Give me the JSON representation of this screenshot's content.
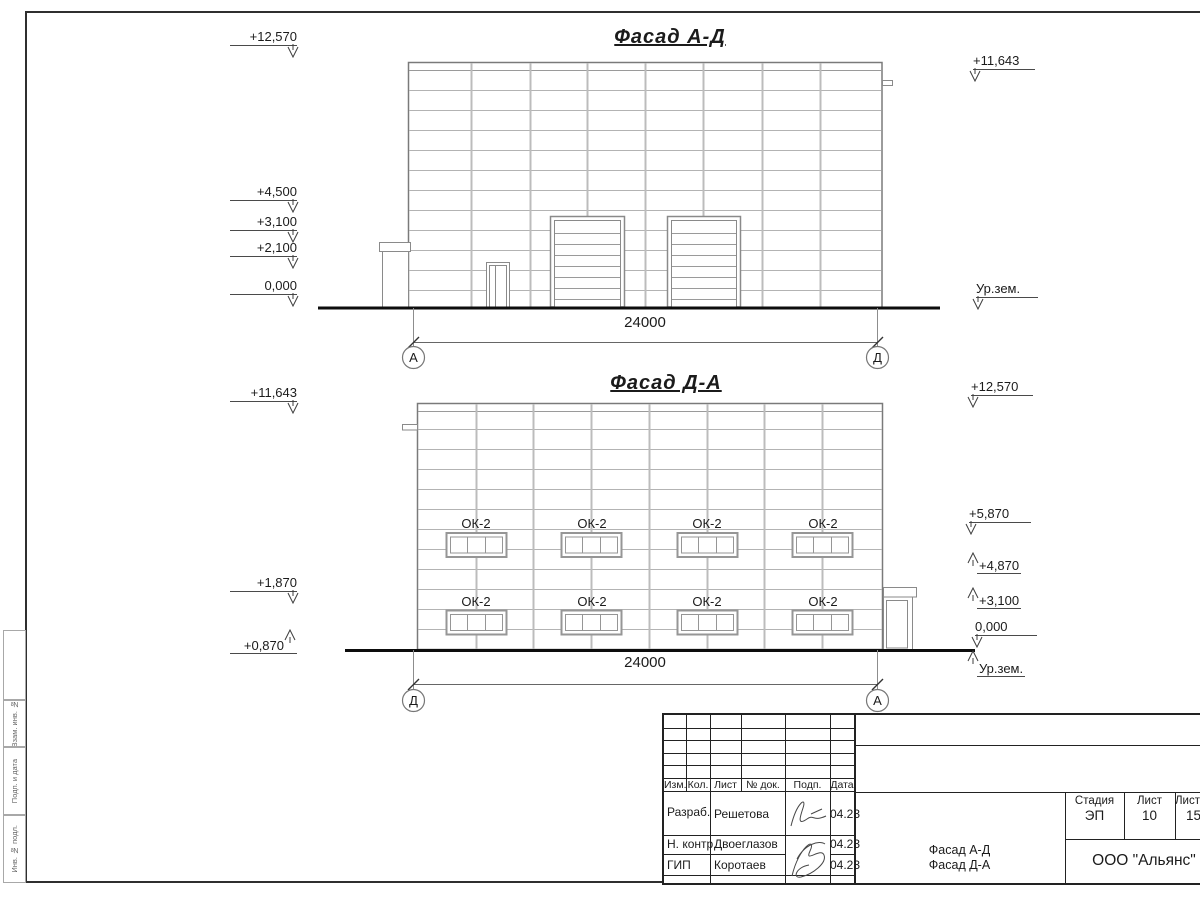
{
  "facade_ad": {
    "title": "Фасад А-Д",
    "dimension_label": "24000",
    "axis_left": "А",
    "axis_right": "Д",
    "marks_left": [
      "+12,570",
      "+4,500",
      "+3,100",
      "+2,100",
      "0,000"
    ],
    "marks_right": [
      "+11,643",
      "Ур.зем."
    ]
  },
  "facade_da": {
    "title": "Фасад Д-А",
    "dimension_label": "24000",
    "axis_left": "Д",
    "axis_right": "А",
    "window_label": "ОК-2",
    "marks_left": [
      "+11,643",
      "+1,870",
      "+0,870"
    ],
    "marks_right": [
      "+12,570",
      "+5,870",
      "+4,870",
      "+3,100",
      "0,000",
      "Ур.зем."
    ]
  },
  "title_block": {
    "header_cols": [
      "Изм.",
      "Кол.",
      "Лист",
      "№ док.",
      "Подп.",
      "Дата"
    ],
    "signers": [
      {
        "role": "Разраб.",
        "name": "Решетова",
        "date": "04.23"
      },
      {
        "role": "Н. контр.",
        "name": "Двоеглазов",
        "date": "04.23"
      },
      {
        "role": "ГИП",
        "name": "Коротаев",
        "date": "04.23"
      }
    ],
    "doc_title_line1": "Фасад А-Д",
    "doc_title_line2": "Фасад Д-А",
    "stage_label": "Стадия",
    "sheet_label": "Лист",
    "sheets_label": "Листов",
    "stage": "ЭП",
    "sheet_no": "10",
    "sheets_total": "15",
    "company": "ООО \"Альянс\""
  },
  "frame": {
    "side_stamps": [
      "Взам. инв. №",
      "Подп. и дата",
      "Инв. № подл."
    ]
  }
}
